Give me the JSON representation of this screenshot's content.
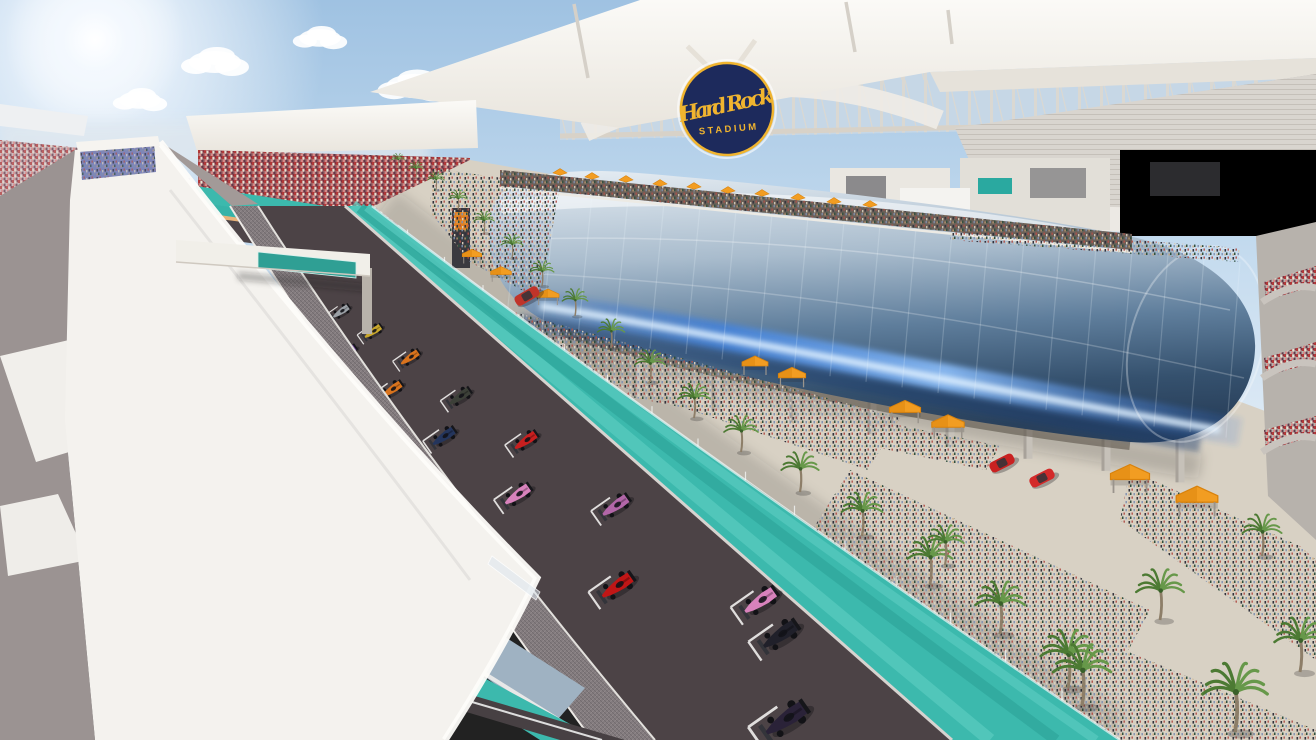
{
  "scene": {
    "type": "architectural-rendering",
    "subject": "Formula 1 cars lined up on the starting grid of the Miami Grand Prix street circuit beside Hard Rock Stadium",
    "details": "sunny sky, teal runoff strips, palm-lined promenade with crowds, orange canopies, curved glass hospitality building, white pit-roof overpass in foreground"
  },
  "stadium": {
    "logo_line1": "Hard Rock",
    "logo_line2": "STADIUM",
    "logo_bg": "#1d2a5c",
    "logo_gold": "#f0b42f"
  },
  "palette": {
    "sky_top": "#9fc2e2",
    "sky_mid": "#c6dcef",
    "sky_low": "#e4eef7",
    "teal": "#3cb9ad",
    "teal_light": "#58cbbf",
    "teal_dark": "#2fa89c",
    "track": "#4c4346",
    "track_dark": "#453d40",
    "apron": "#837b7e",
    "curb": "#e2e0dc",
    "roof_white": "#f4f2ee",
    "ground": "#9b9392",
    "promenade": "#d8d1c4",
    "orange": "#f29d22",
    "orange_dark": "#d9820c",
    "palm_green": "#4c7a33",
    "palm_green2": "#67984a",
    "trunk": "#8d7e68",
    "glass_light": "#e6edf3",
    "glass_mid": "#8aa3ba",
    "glass_dark": "#41607e",
    "glass_deep": "#2a415c",
    "streak_blue": "#2f6fd8",
    "streak_core": "#dff0ff",
    "wall_blue": "#9fb2c2",
    "canopy": "#f2efe9",
    "truss": "#d8d2c8",
    "seat_gray": "#d9d5cf",
    "red_car": "#c92121"
  },
  "clouds": [
    [
      215,
      62,
      1
    ],
    [
      320,
      38,
      0.8
    ],
    [
      415,
      86,
      1.1
    ],
    [
      505,
      58,
      0.7
    ],
    [
      690,
      30,
      0.6
    ],
    [
      770,
      92,
      0.9
    ],
    [
      850,
      22,
      0.7
    ],
    [
      1010,
      55,
      1
    ],
    [
      1130,
      85,
      0.9
    ],
    [
      1245,
      48,
      1.1
    ],
    [
      1300,
      98,
      0.7
    ],
    [
      140,
      100,
      0.8
    ],
    [
      598,
      64,
      0.5
    ],
    [
      955,
      95,
      0.6
    ]
  ],
  "grid_cars": [
    {
      "x": 342,
      "y": 311,
      "len": 21,
      "color": "#9aa0a6",
      "name": "silver"
    },
    {
      "x": 321,
      "y": 327,
      "len": 22,
      "color": "#b8402e",
      "name": "dark-red"
    },
    {
      "x": 374,
      "y": 331,
      "len": 22,
      "color": "#c9a72c",
      "name": "yellow"
    },
    {
      "x": 348,
      "y": 352,
      "len": 23,
      "color": "#6f3d99",
      "name": "purple"
    },
    {
      "x": 411,
      "y": 357,
      "len": 24,
      "color": "#d9731d",
      "name": "orange"
    },
    {
      "x": 393,
      "y": 389,
      "len": 26,
      "color": "#d9731d",
      "name": "orange"
    },
    {
      "x": 461,
      "y": 396,
      "len": 27,
      "color": "#3c4038",
      "name": "graphite"
    },
    {
      "x": 445,
      "y": 436,
      "len": 29,
      "color": "#24355c",
      "name": "navy"
    },
    {
      "x": 527,
      "y": 440,
      "len": 29,
      "color": "#c81f1f",
      "name": "red"
    },
    {
      "x": 519,
      "y": 494,
      "len": 33,
      "color": "#d882bc",
      "name": "pink"
    },
    {
      "x": 617,
      "y": 505,
      "len": 34,
      "color": "#b266a8",
      "name": "magenta"
    },
    {
      "x": 619,
      "y": 585,
      "len": 40,
      "color": "#c01616",
      "name": "red"
    },
    {
      "x": 762,
      "y": 600,
      "len": 41,
      "color": "#d882bc",
      "name": "pink"
    },
    {
      "x": 782,
      "y": 634,
      "len": 44,
      "color": "#20202a",
      "name": "black"
    },
    {
      "x": 788,
      "y": 718,
      "len": 52,
      "color": "#2a2238",
      "name": "dark-purple"
    }
  ],
  "palms": [
    [
      398,
      168,
      0.4
    ],
    [
      416,
      178,
      0.45
    ],
    [
      436,
      190,
      0.5
    ],
    [
      458,
      210,
      0.55
    ],
    [
      484,
      233,
      0.6
    ],
    [
      512,
      258,
      0.65
    ],
    [
      542,
      286,
      0.7
    ],
    [
      575,
      316,
      0.75
    ],
    [
      611,
      348,
      0.8
    ],
    [
      650,
      382,
      0.88
    ],
    [
      694,
      418,
      0.95
    ],
    [
      741,
      452,
      1.0
    ],
    [
      800,
      492,
      1.1
    ],
    [
      862,
      536,
      1.2
    ],
    [
      930,
      585,
      1.32
    ],
    [
      1000,
      634,
      1.45
    ],
    [
      1068,
      688,
      1.6
    ],
    [
      945,
      565,
      1.1
    ],
    [
      1160,
      620,
      1.4
    ],
    [
      1082,
      706,
      1.7
    ],
    [
      1235,
      732,
      1.9
    ],
    [
      1300,
      672,
      1.5
    ],
    [
      1262,
      556,
      1.15
    ]
  ],
  "umbrellas_rooftop": [
    [
      560,
      176
    ],
    [
      592,
      180
    ],
    [
      626,
      183
    ],
    [
      660,
      187
    ],
    [
      694,
      190
    ],
    [
      728,
      194
    ],
    [
      762,
      197
    ],
    [
      798,
      201
    ],
    [
      834,
      205
    ],
    [
      870,
      208
    ]
  ],
  "tents_promenade": [
    [
      472,
      259,
      0.75
    ],
    [
      501,
      277,
      0.8
    ],
    [
      548,
      300,
      0.85
    ],
    [
      755,
      369,
      1.0
    ],
    [
      792,
      381,
      1.05
    ],
    [
      905,
      416,
      1.2
    ],
    [
      948,
      431,
      1.25
    ],
    [
      1130,
      484,
      1.5
    ],
    [
      1197,
      507,
      1.6
    ]
  ],
  "sports_cars": [
    {
      "x": 1002,
      "y": 463,
      "angle": -27,
      "color": "#c92121"
    },
    {
      "x": 1042,
      "y": 478,
      "angle": -27,
      "color": "#d32a2a"
    },
    {
      "x": 527,
      "y": 296,
      "angle": -30,
      "color": "#c0342a"
    }
  ],
  "fence": {
    "p0": [
      372,
      206
    ],
    "p1": [
      650,
      420
    ],
    "p2": [
      1120,
      740
    ],
    "posts": 15
  },
  "columns": {
    "xs": [
      560,
      638,
      716,
      794,
      872,
      950,
      1028,
      1106,
      1180
    ]
  },
  "mullions": {
    "x0": 520,
    "x1": 1240,
    "step": 36
  }
}
